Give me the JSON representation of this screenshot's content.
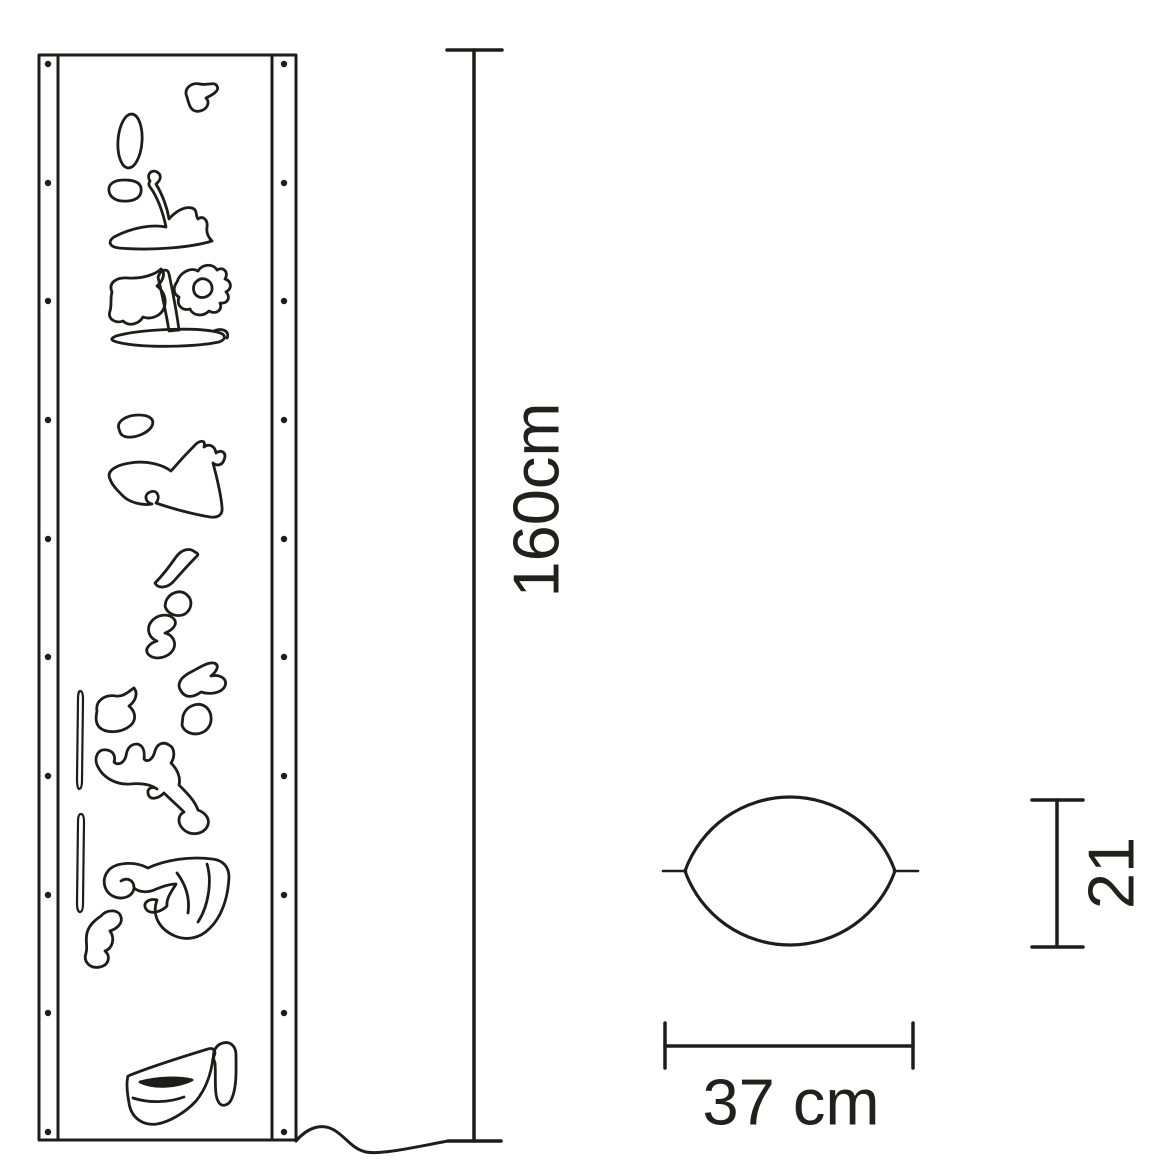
{
  "colors": {
    "line": "#1d1d1b",
    "background": "#ffffff"
  },
  "dimensions": {
    "height_label": "160cm",
    "width_label": "37 cm",
    "depth_label": "21"
  }
}
